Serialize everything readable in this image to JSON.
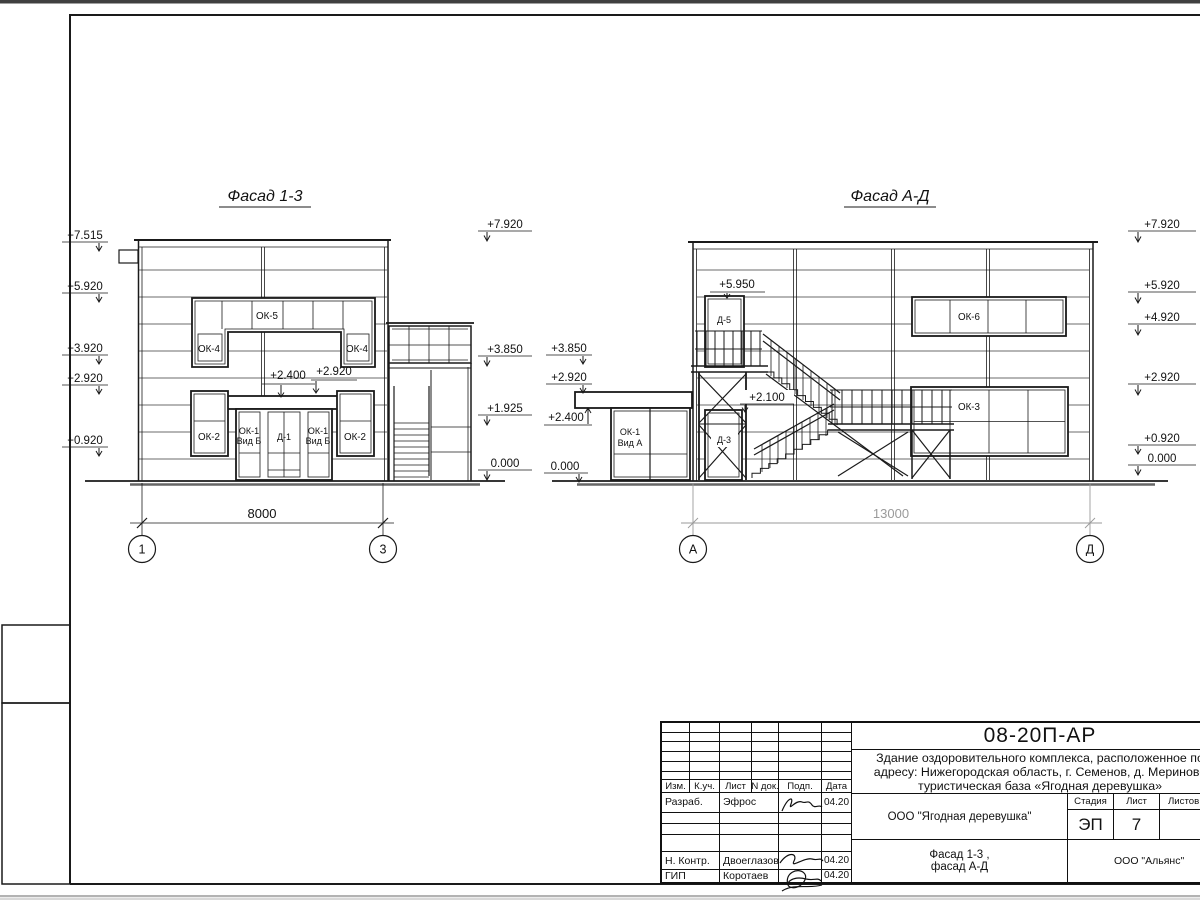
{
  "sheet": {
    "doc_number": "08-20П-АР",
    "description_line1": "Здание оздоровительного комплекса, расположенное по",
    "description_line2": "адресу: Нижегородская область, г. Семенов, д. Мериново",
    "description_line3": "туристическая база «Ягодная деревушка»",
    "client": "ООО \"Ягодная деревушка\"",
    "sheet_title_line1": "Фасад 1-3 ,",
    "sheet_title_line2": "фасад А-Д",
    "organization": "ООО \"Альянс\"",
    "stage_label": "Стадия",
    "sheet_label": "Лист",
    "sheets_label": "Листов",
    "stage_value": "ЭП",
    "sheet_value": "7",
    "columns": {
      "izm": "Изм.",
      "kuch": "К.уч.",
      "list": "Лист",
      "ndok": "N док.",
      "podp": "Подп.",
      "data": "Дата"
    },
    "rows": [
      {
        "role": "Разраб.",
        "name": "Эфрос",
        "date": "04.20"
      },
      {
        "role": "Н. Контр.",
        "name": "Двоеглазов",
        "date": "04.20"
      },
      {
        "role": "ГИП",
        "name": "Коротаев",
        "date": "04.20"
      }
    ]
  },
  "facade13": {
    "title": "Фасад 1-3",
    "elev_left": [
      "+7.515",
      "+5.920",
      "+3.920",
      "+2.920",
      "+0.920"
    ],
    "elev_right": [
      "+7.920",
      "+3.850",
      "+1.925",
      "0.000"
    ],
    "ann": {
      "a1": "+2.400",
      "a2": "+2.920"
    },
    "win": {
      "ok5": "ОК-5",
      "ok4": "ОК-4",
      "ok2": "ОК-2",
      "ok1": "ОК-1",
      "vid": "Вид Б",
      "d1": "Д-1"
    },
    "dimension": "8000",
    "axis_left": "1",
    "axis_right": "3"
  },
  "facadeAD": {
    "title": "Фасад А-Д",
    "elev_left": [
      "+3.850",
      "+2.920",
      "+2.400",
      "0.000"
    ],
    "elev_right": [
      "+7.920",
      "+5.920",
      "+4.920",
      "+2.920",
      "+0.920",
      "0.000"
    ],
    "ann": {
      "a1": "+5.950",
      "a2": "+2.100"
    },
    "win": {
      "ok6": "ОК-6",
      "ok3": "ОК-3",
      "ok1": "ОК-1",
      "vid": "Вид А",
      "d5": "Д-5",
      "d3": "Д-3"
    },
    "dimension": "13000",
    "axis_left": "А",
    "axis_right": "Д"
  }
}
